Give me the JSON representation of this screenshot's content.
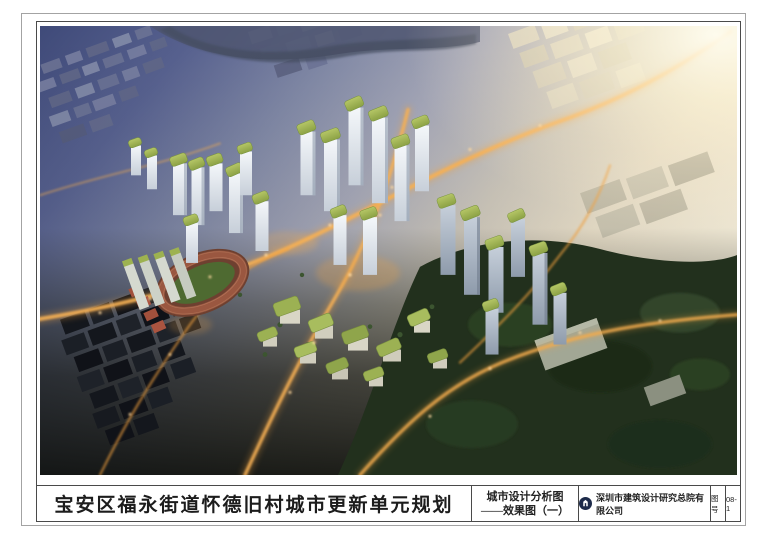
{
  "title_block": {
    "project_title": "宝安区福永街道怀德旧村城市更新单元规划",
    "drawing_name_line1": "城市设计分析图",
    "drawing_name_line2": "——效果图（一）",
    "company": "深圳市建筑设计研究总院有限公司",
    "sheet_no_label": "图号",
    "sheet_no_value": "08-1"
  },
  "rendering_icons": {
    "sun_glare": "sun-glare",
    "sports_track": "running-track",
    "road_network": "lit-road-network",
    "tower_cluster": "green-roof-towers",
    "urban_village": "dark-industrial-blocks",
    "forest": "forest-park"
  },
  "palette": {
    "dusk_blue": "#454f7e",
    "context_blue_grey": "#767da0",
    "sun_glow": "#fff8e1",
    "street_light_orange": "#f0a23f",
    "roof_green": "#9cb153",
    "facade_white": "#edf1f5",
    "forest_green": "#22301d",
    "dark_blocks": "#15181e",
    "track_red": "#8a4b38",
    "infield_green": "#4e6a31",
    "logo_navy": "#1d2a4a",
    "frame_line": "#4a4a4a"
  }
}
